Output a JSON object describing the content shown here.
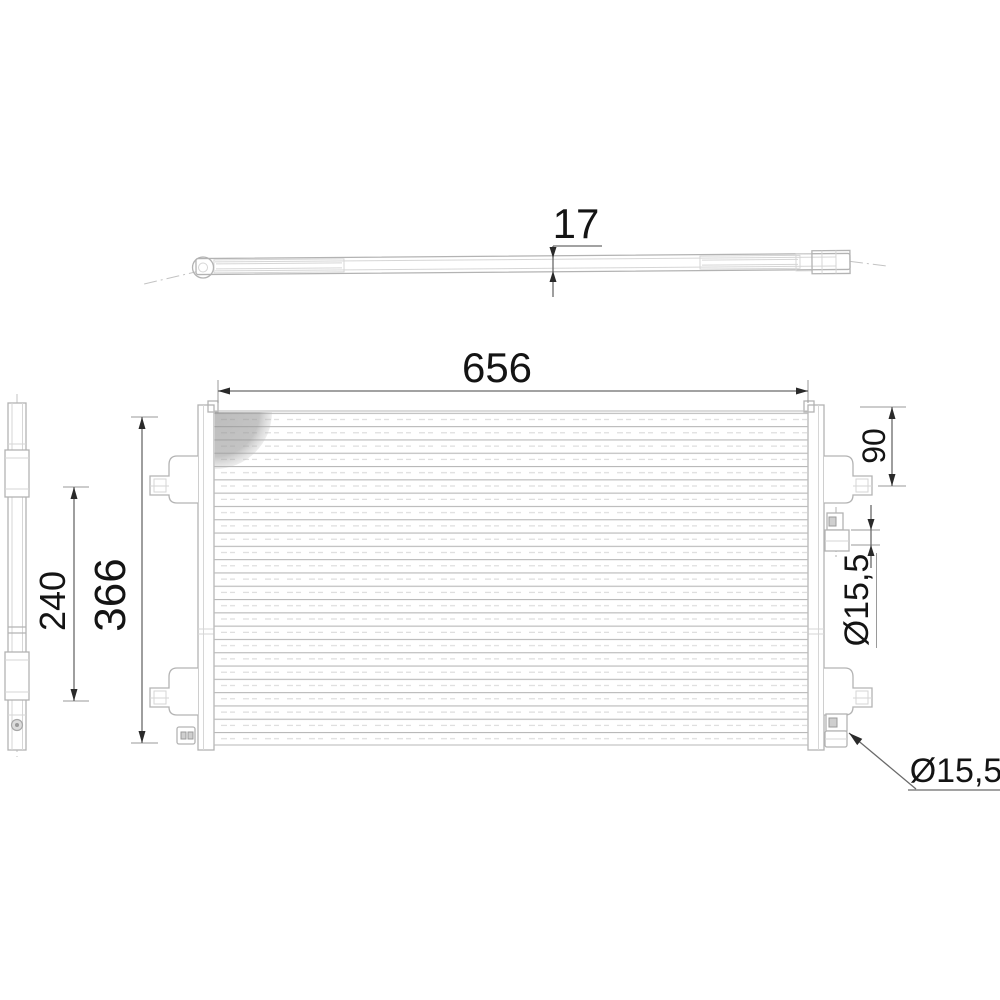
{
  "title": "Condenser engineering drawing",
  "colors": {
    "background": "#ffffff",
    "part-line": "#b3b3b3",
    "part-line-light": "#d6d6d6",
    "part-fill": "#ffffff",
    "dim-line": "#6a6a6a",
    "ext-line": "#9a9a9a",
    "arrow": "#2a2a2a",
    "dim-text": "#141414",
    "centerline": "#c3c3c3",
    "shade": "#979797",
    "fin-line": "#b8b8b8",
    "fin-dash": "#dadada"
  },
  "dimensions": {
    "thickness": "17",
    "core_width": "656",
    "overall_height": "366",
    "bracket_spacing": "240",
    "inlet_offset": "90",
    "port_diameter_top": "Ø15,5",
    "port_diameter_bottom": "Ø15,5"
  }
}
